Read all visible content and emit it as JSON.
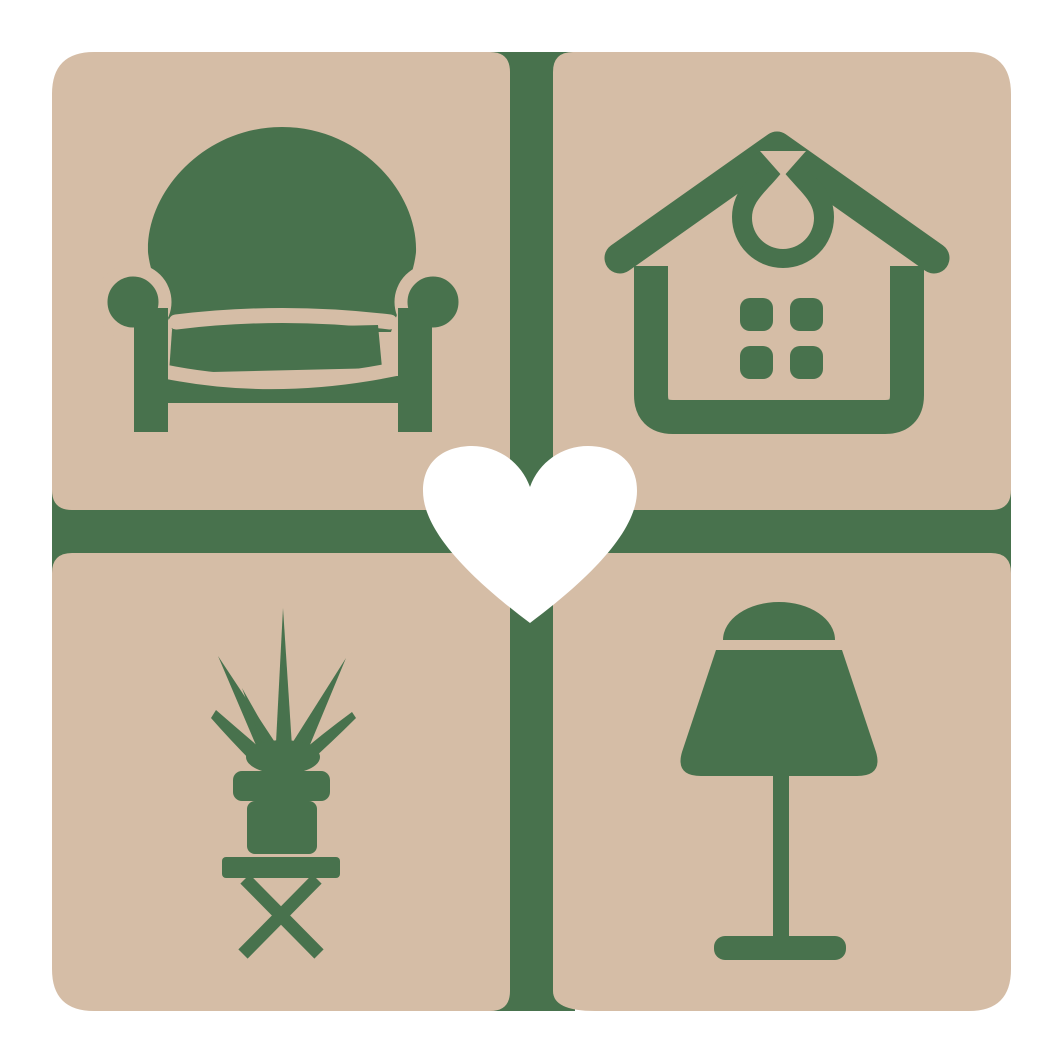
{
  "meta": {
    "title": "Home furniture heart logo",
    "kind": "logo-graphic",
    "description": "Four rounded tan tiles in a 2x2 grid separated by a green cross, each tile holding a green home-furnishing icon (armchair, house, potted plant on stool, table lamp), with a white heart at the center."
  },
  "colors": {
    "background": "#ffffff",
    "tan": "#d5bda6",
    "green": "#48724d",
    "white": "#ffffff"
  },
  "logo": {
    "grid": {
      "rows": 2,
      "cols": 2
    },
    "divider": {
      "shape": "cross",
      "color": "#48724d"
    },
    "tiles": [
      {
        "id": "top-left",
        "icon": "armchair"
      },
      {
        "id": "top-right",
        "icon": "house"
      },
      {
        "id": "bottom-left",
        "icon": "potted-plant-on-stool"
      },
      {
        "id": "bottom-right",
        "icon": "table-lamp"
      }
    ],
    "center": {
      "icon": "heart",
      "color": "#ffffff"
    }
  }
}
